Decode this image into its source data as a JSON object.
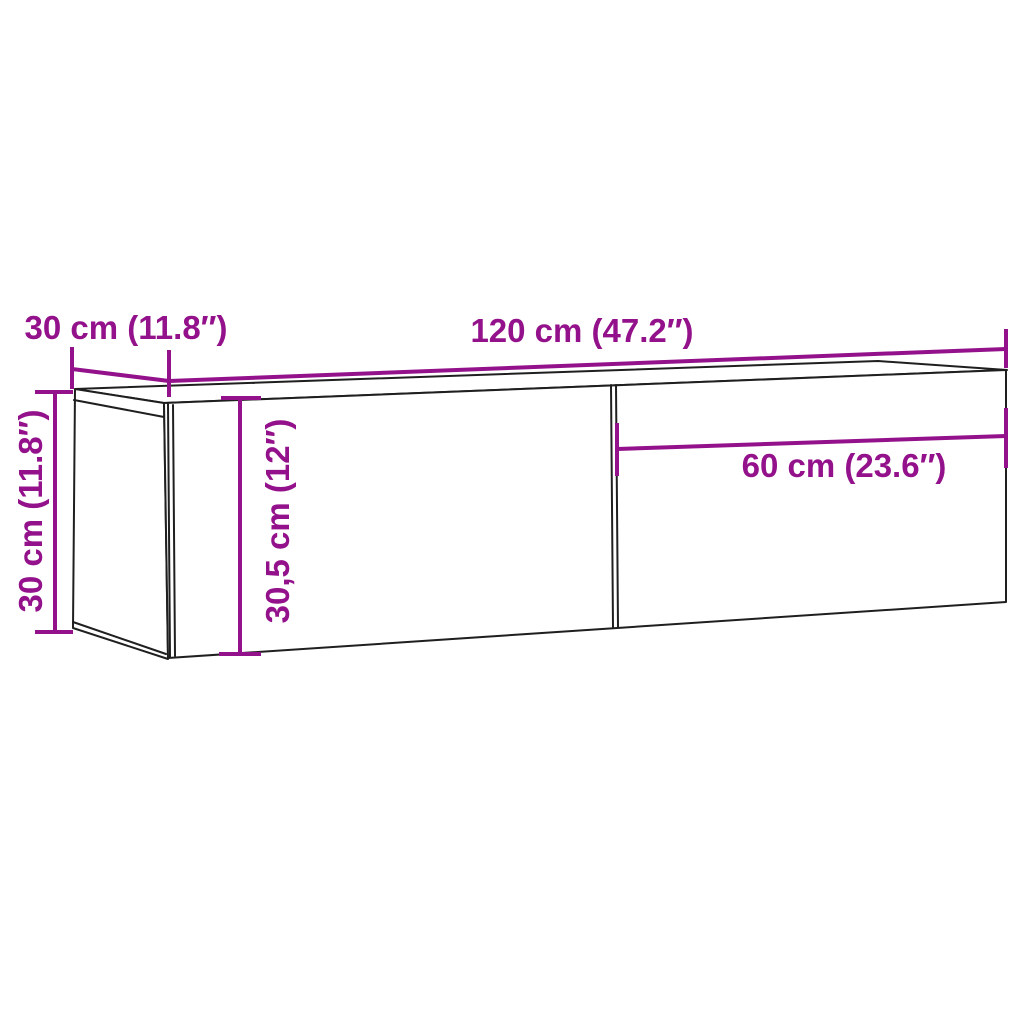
{
  "colors": {
    "dimension_annotation": "#93118A",
    "outline": "#1f1f1f",
    "background": "#ffffff"
  },
  "labels": {
    "top_width": "120 cm (47.2″)",
    "top_depth": "30 cm (11.8″)",
    "left_height": "30 cm (11.8″)",
    "inner_height": "30,5 cm (12″)",
    "right_section_width": "60 cm (23.6″)"
  }
}
